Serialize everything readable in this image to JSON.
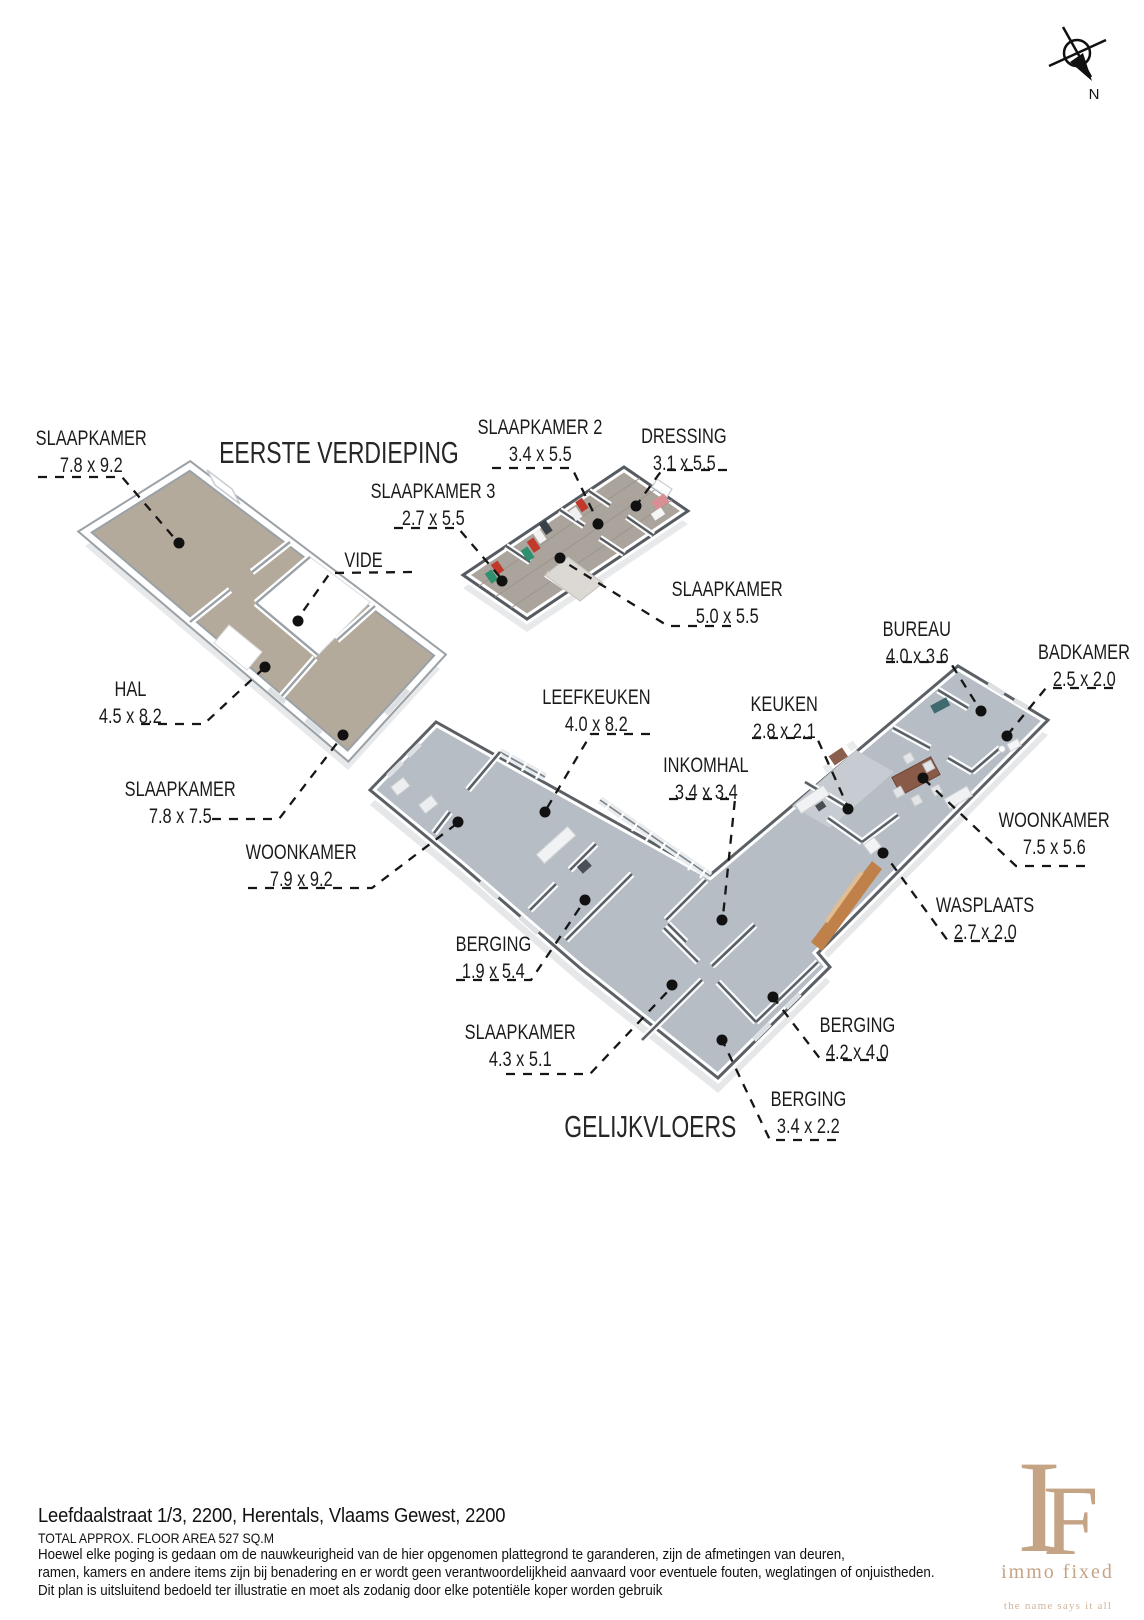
{
  "compass": {
    "label": "N"
  },
  "floor1": {
    "title": "EERSTE VERDIEPING",
    "labels": [
      {
        "name": "SLAAPKAMER",
        "dims": "7.8 x 9.2"
      },
      {
        "name": "SLAAPKAMER 2",
        "dims": "3.4 x 5.5"
      },
      {
        "name": "DRESSING",
        "dims": "3.1 x 5.5"
      },
      {
        "name": "SLAAPKAMER 3",
        "dims": "2.7 x 5.5"
      },
      {
        "name": "VIDE",
        "dims": ""
      },
      {
        "name": "SLAAPKAMER",
        "dims": "5.0 x 5.5"
      },
      {
        "name": "HAL",
        "dims": "4.5 x 8.2"
      },
      {
        "name": "SLAAPKAMER",
        "dims": "7.8 x 7.5"
      }
    ]
  },
  "floor0": {
    "title": "GELIJKVLOERS",
    "labels": [
      {
        "name": "WOONKAMER",
        "dims": "7.9 x 9.2"
      },
      {
        "name": "LEEFKEUKEN",
        "dims": "4.0 x 8.2"
      },
      {
        "name": "KEUKEN",
        "dims": "2.8 x 2.1"
      },
      {
        "name": "BUREAU",
        "dims": "4.0 x 3.6"
      },
      {
        "name": "BADKAMER",
        "dims": "2.5 x 2.0"
      },
      {
        "name": "INKOMHAL",
        "dims": "3.4 x 3.4"
      },
      {
        "name": "WOONKAMER",
        "dims": "7.5 x 5.6"
      },
      {
        "name": "WASPLAATS",
        "dims": "2.7 x 2.0"
      },
      {
        "name": "BERGING",
        "dims": "1.9 x 5.4"
      },
      {
        "name": "SLAAPKAMER",
        "dims": "4.3 x 5.1"
      },
      {
        "name": "BERGING",
        "dims": "4.2 x 4.0"
      },
      {
        "name": "BERGING",
        "dims": "3.4 x 2.2"
      }
    ]
  },
  "footer": {
    "address": "Leefdaalstraat 1/3, 2200, Herentals, Vlaams Gewest, 2200",
    "area": "TOTAL APPROX. FLOOR AREA 527 SQ.M",
    "disclaimer1": "Hoewel elke poging is gedaan om de nauwkeurigheid van de hier opgenomen plattegrond te garanderen, zijn de afmetingen van deuren,",
    "disclaimer2": "ramen, kamers en andere items zijn bij benadering en er wordt geen verantwoordelijkheid aanvaard voor eventuele fouten, weglatingen of onjuistheden.",
    "disclaimer3": "Dit plan is uitsluitend bedoeld ter illustratie en moet als zodanig door elke potentiële koper worden gebruik"
  },
  "logo": {
    "monogram_i": "I",
    "monogram_f": "F",
    "name": "immo fixed",
    "tagline": "the name says it all",
    "accent": "#c5a385"
  },
  "colors": {
    "floor1_floor": "#b4aa9b",
    "floor1_wood": "#aba49c",
    "floor0_floor": "#b7bdc5",
    "brick_wall": "#c08049",
    "wall_top_dark": "#5a6065",
    "wall_top_light": "#9aa1a7",
    "leader_line": "#161616"
  }
}
